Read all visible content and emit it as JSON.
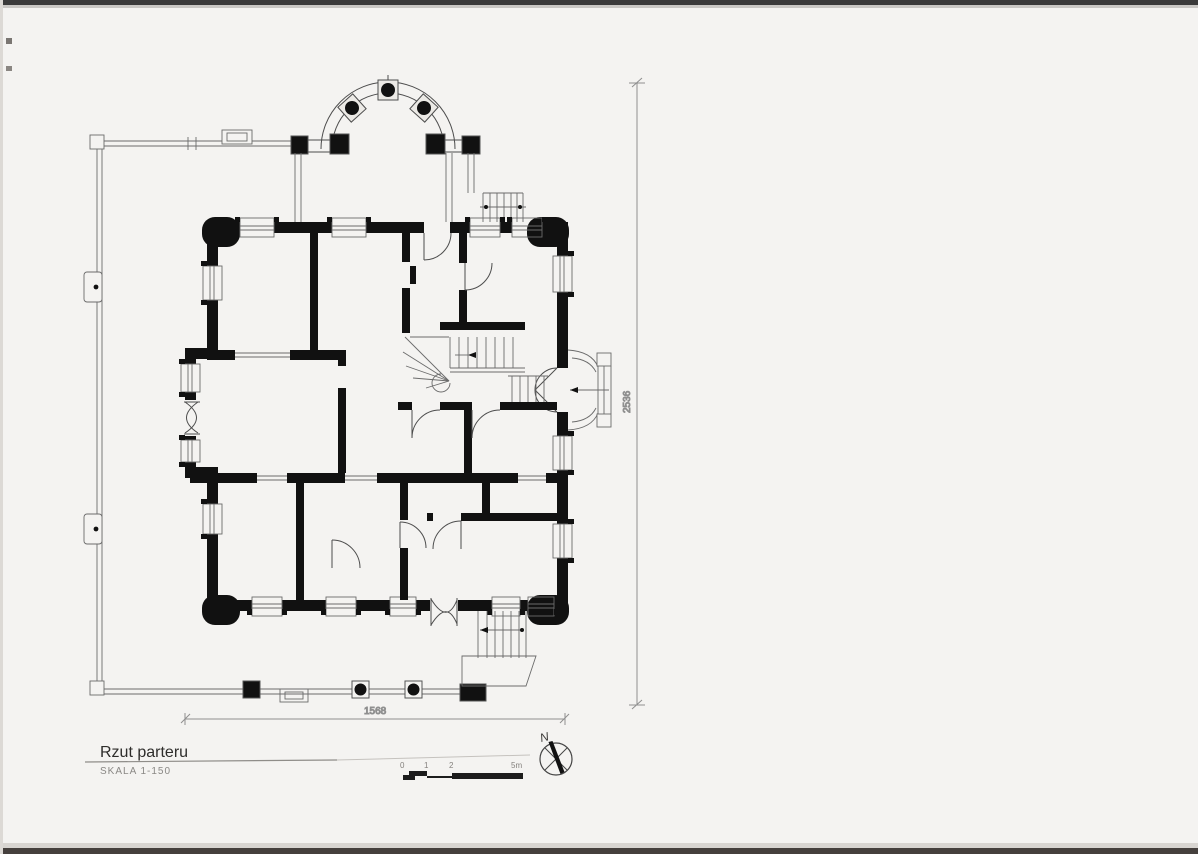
{
  "document": {
    "title": "Rzut parteru",
    "scale_label": "SKALA 1-150"
  },
  "dimensions": {
    "horizontal_length": "1568",
    "vertical_length": "2536"
  },
  "scale_bar": {
    "labels": [
      "0",
      "1",
      "2",
      "5m"
    ]
  },
  "compass": {
    "north_label": "N"
  },
  "colors": {
    "paper": "#f4f3f1",
    "wall_ink": "#111111",
    "thin_line": "#4d4d4d",
    "dimension_line": "#8f8f8f",
    "scan_edge": "#3a3a3a"
  }
}
